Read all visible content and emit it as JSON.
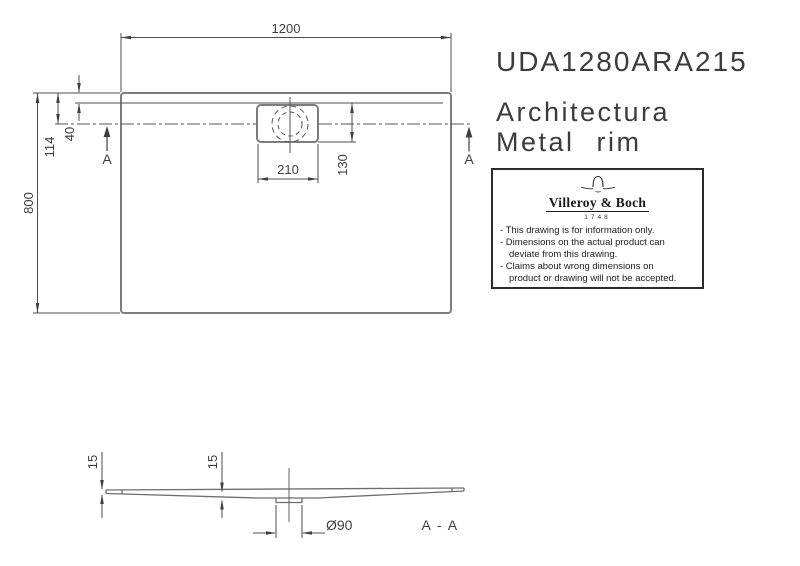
{
  "title": {
    "product_code": "UDA1280ARA215",
    "series": "Architectura",
    "variant": "Metal rim"
  },
  "info_box": {
    "brand": "Villeroy & Boch",
    "established": "1748",
    "lines": [
      "- This drawing is for information only.",
      "- Dimensions on the actual product can",
      "deviate from this drawing.",
      "- Claims about wrong dimensions on",
      "product or drawing will not be accepted."
    ]
  },
  "plan": {
    "dim_width": "1200",
    "dim_depth": "800",
    "dim_drain_center_from_edge": "114",
    "dim_rim_inset": "40",
    "dim_drain_cutout_width": "210",
    "dim_drain_cutout_height": "130",
    "section_marker_left": "A",
    "section_marker_right": "A"
  },
  "section": {
    "dim_edge_height": "15",
    "dim_center_height": "15",
    "dim_drain_diameter": "Ø90",
    "label": "A - A"
  },
  "colors": {
    "outline": "#7d7d7d",
    "line": "#4d4d4d",
    "text": "#3f3f3f",
    "background": "#ffffff"
  }
}
